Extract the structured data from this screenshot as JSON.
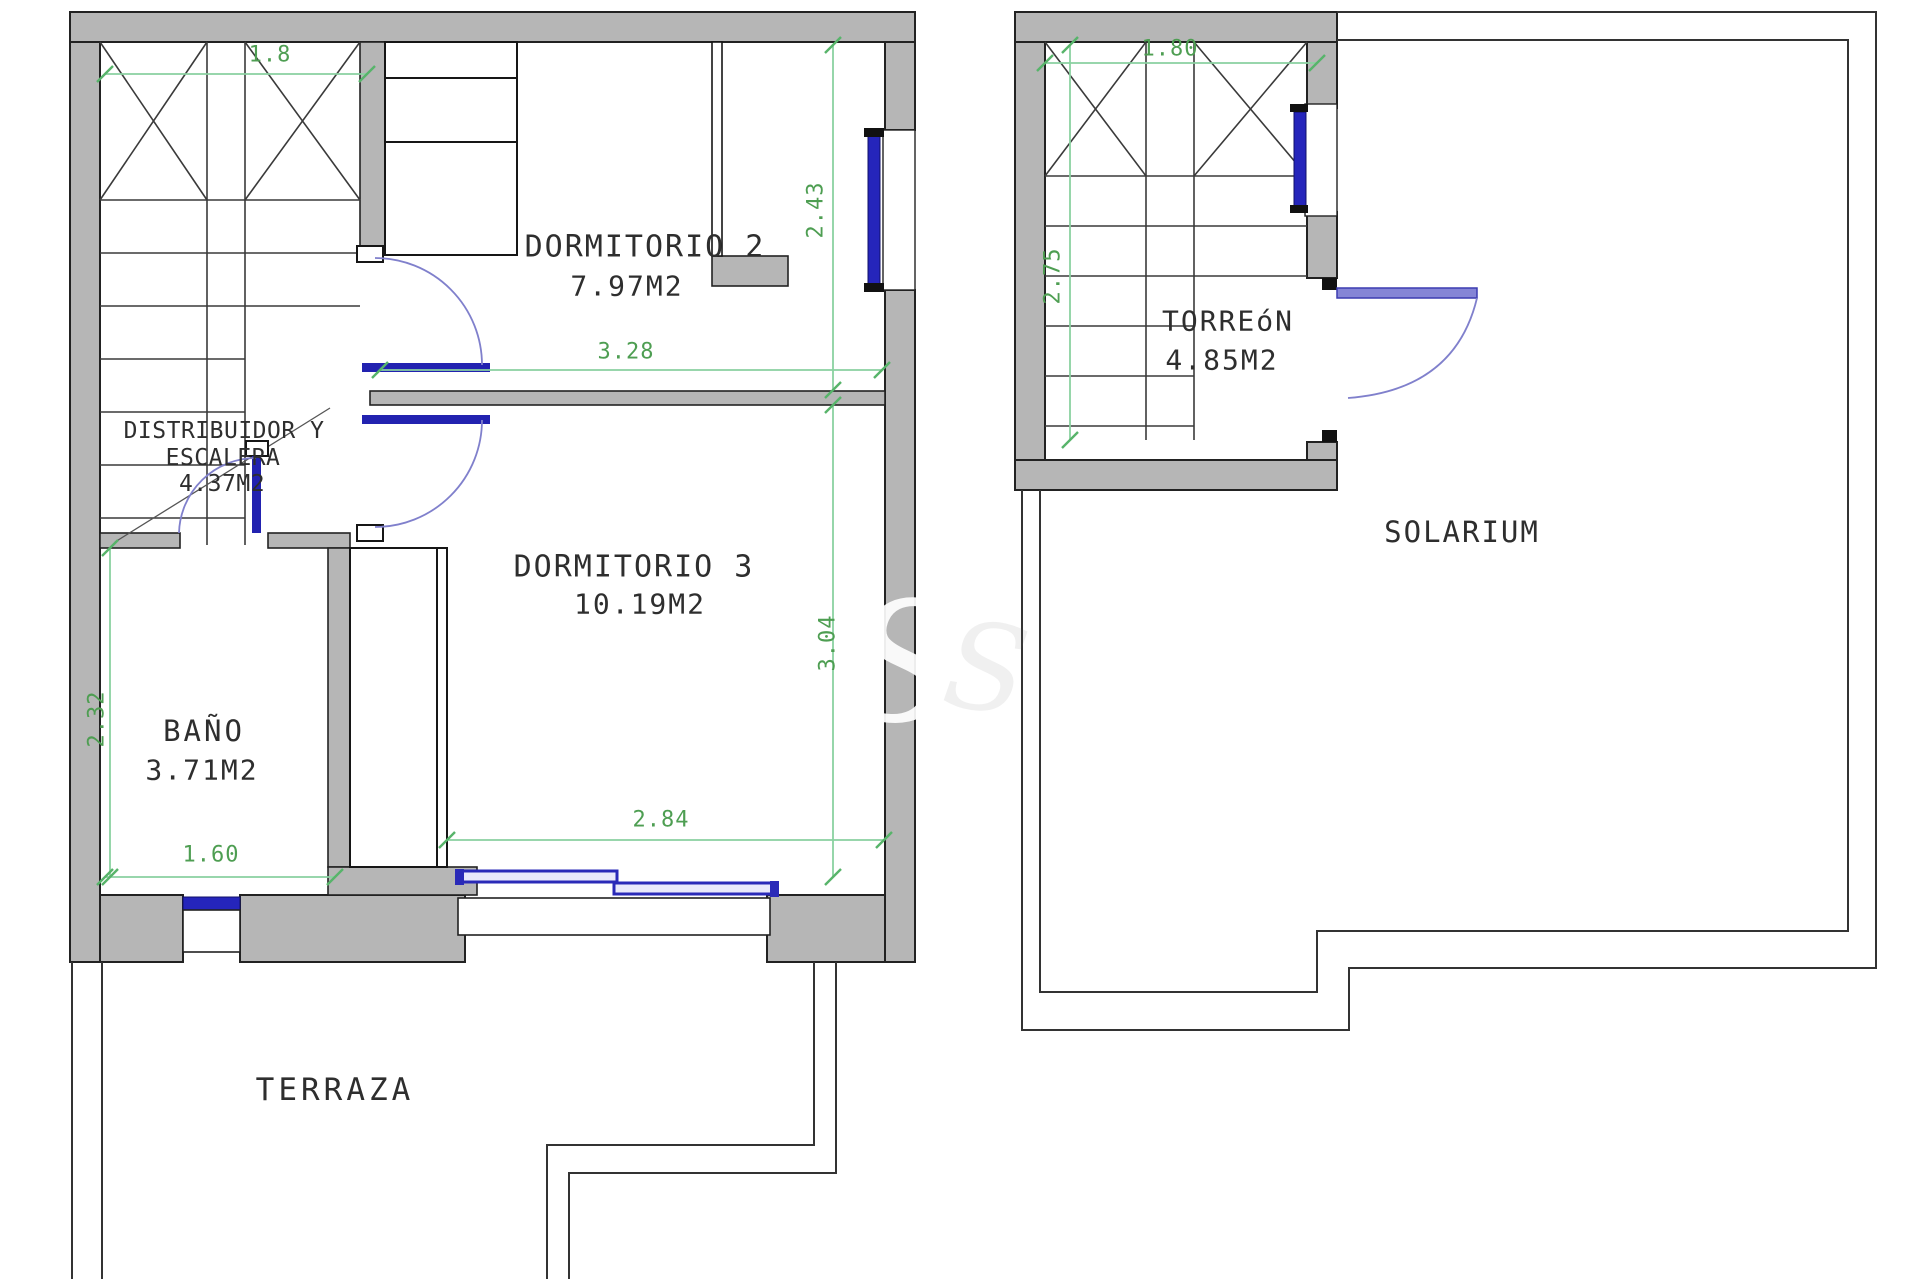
{
  "watermark_text": "S",
  "floorplan": {
    "upper": {
      "rooms": {
        "dormitorio2": {
          "name": "DORMITORIO 2",
          "area": "7.97M2"
        },
        "dormitorio3": {
          "name": "DORMITORIO 3",
          "area": "10.19M2"
        },
        "distribuidor": {
          "line1": "DISTRIBUIDOR Y",
          "line2": "ESCALERA",
          "area": "4.37M2"
        },
        "bano": {
          "name": "BAÑO",
          "area": "3.71M2"
        },
        "terraza": {
          "name": "TERRAZA"
        }
      },
      "dimensions": {
        "stair_width": "1.8",
        "dorm2_depth": "2.43",
        "dorm2_width": "3.28",
        "dorm3_depth": "3.04",
        "dorm3_width": "2.84",
        "bano_width": "1.60",
        "bano_depth": "2.32"
      }
    },
    "roof": {
      "rooms": {
        "torreon": {
          "name": "TORREóN",
          "area": "4.85M2"
        },
        "solarium": {
          "name": "SOLARIUM"
        }
      },
      "dimensions": {
        "stair_width": "1.80",
        "stair_depth": "2.75"
      }
    }
  },
  "colors": {
    "wall_fill": "#b6b6b6",
    "dimension_green": "#4e9e52",
    "window_blue": "#2525bb",
    "door_arc_blue": "#8080cc"
  }
}
